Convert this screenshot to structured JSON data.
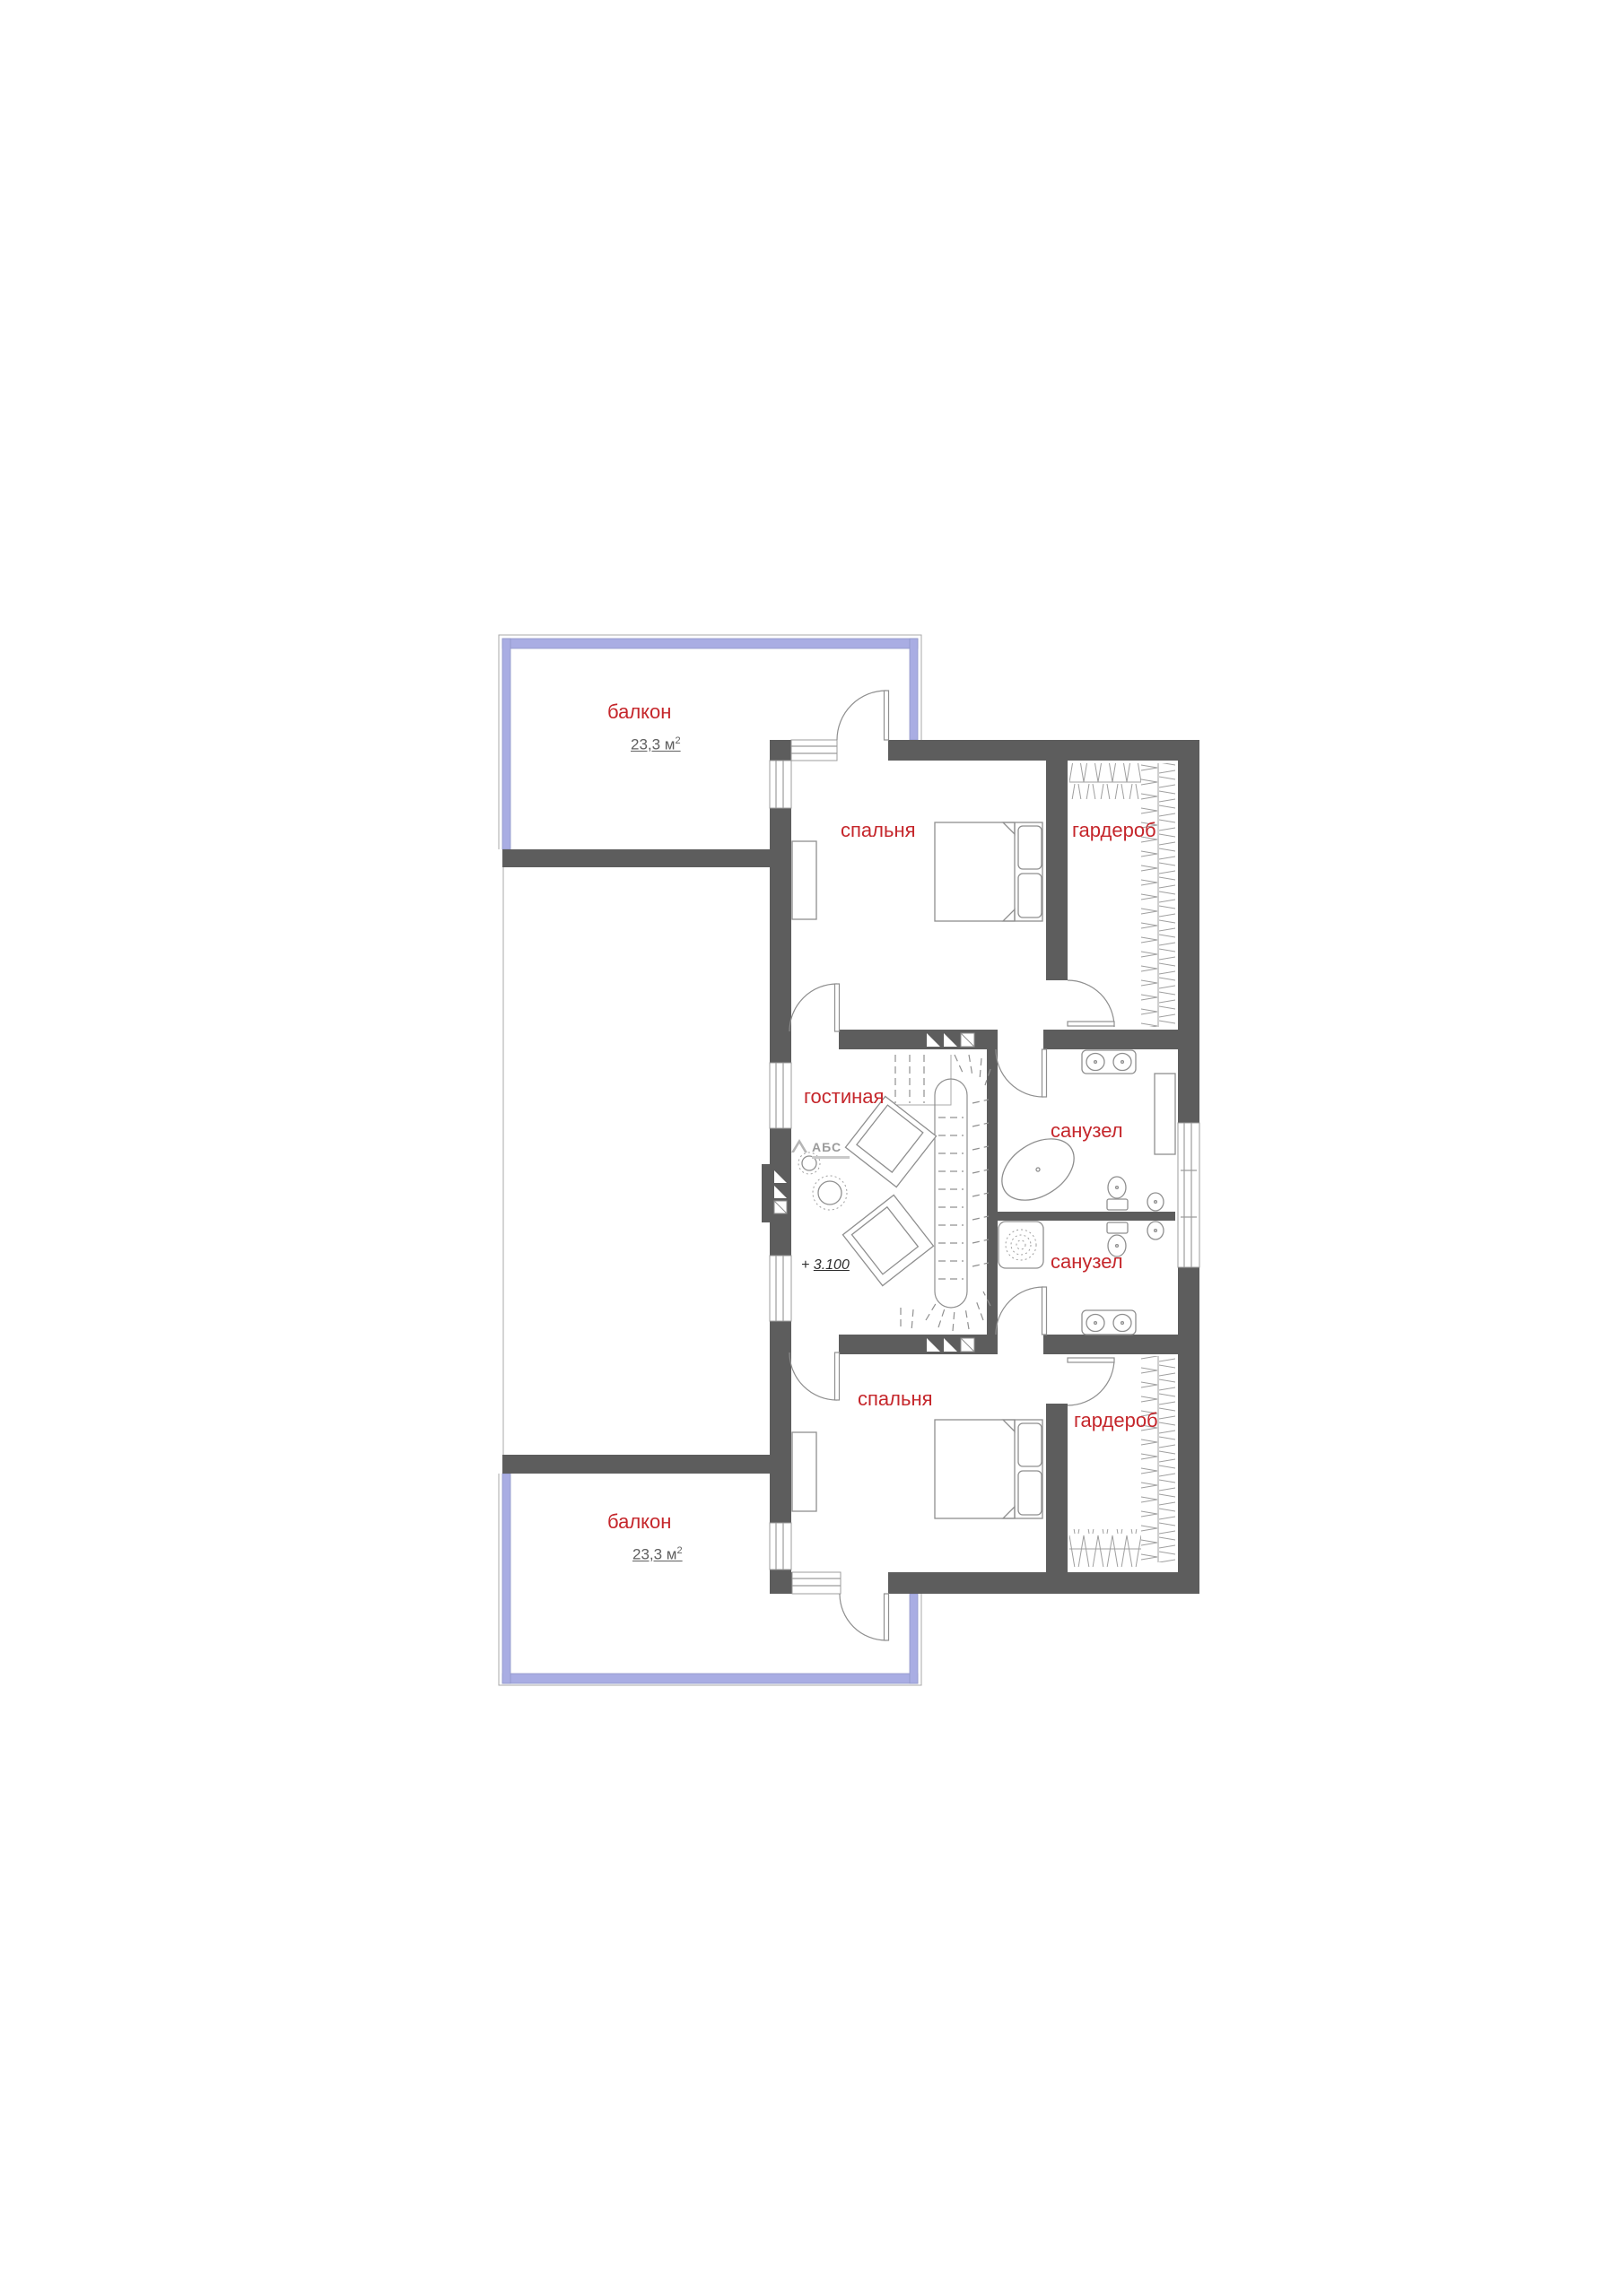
{
  "page": {
    "background": "#ffffff",
    "kind": "architectural floor plan"
  },
  "colors": {
    "wall": "#5d5d5d",
    "label": "#c5262b",
    "area_text": "#5f5f5f",
    "railing": "#a9ade3",
    "railing_border": "#9096c9",
    "furn": "#8f8f8f"
  },
  "labels": {
    "balcony_top": {
      "name": "балкон",
      "area": "23,3 м",
      "area_sup": "2"
    },
    "bedroom_top": {
      "name": "спальня"
    },
    "wardrobe_top": {
      "name": "гардероб"
    },
    "living": {
      "name": "гостиная"
    },
    "bath_top": {
      "name": "санузел"
    },
    "bath_bottom": {
      "name": "санузел"
    },
    "bedroom_bottom": {
      "name": "спальня"
    },
    "wardrobe_bottom": {
      "name": "гардероб"
    },
    "balcony_bottom": {
      "name": "балкон",
      "area": "23,3 м",
      "area_sup": "2"
    },
    "elevation": {
      "plus": "+",
      "value": "3.100"
    },
    "logo": {
      "text": "АБС"
    }
  }
}
